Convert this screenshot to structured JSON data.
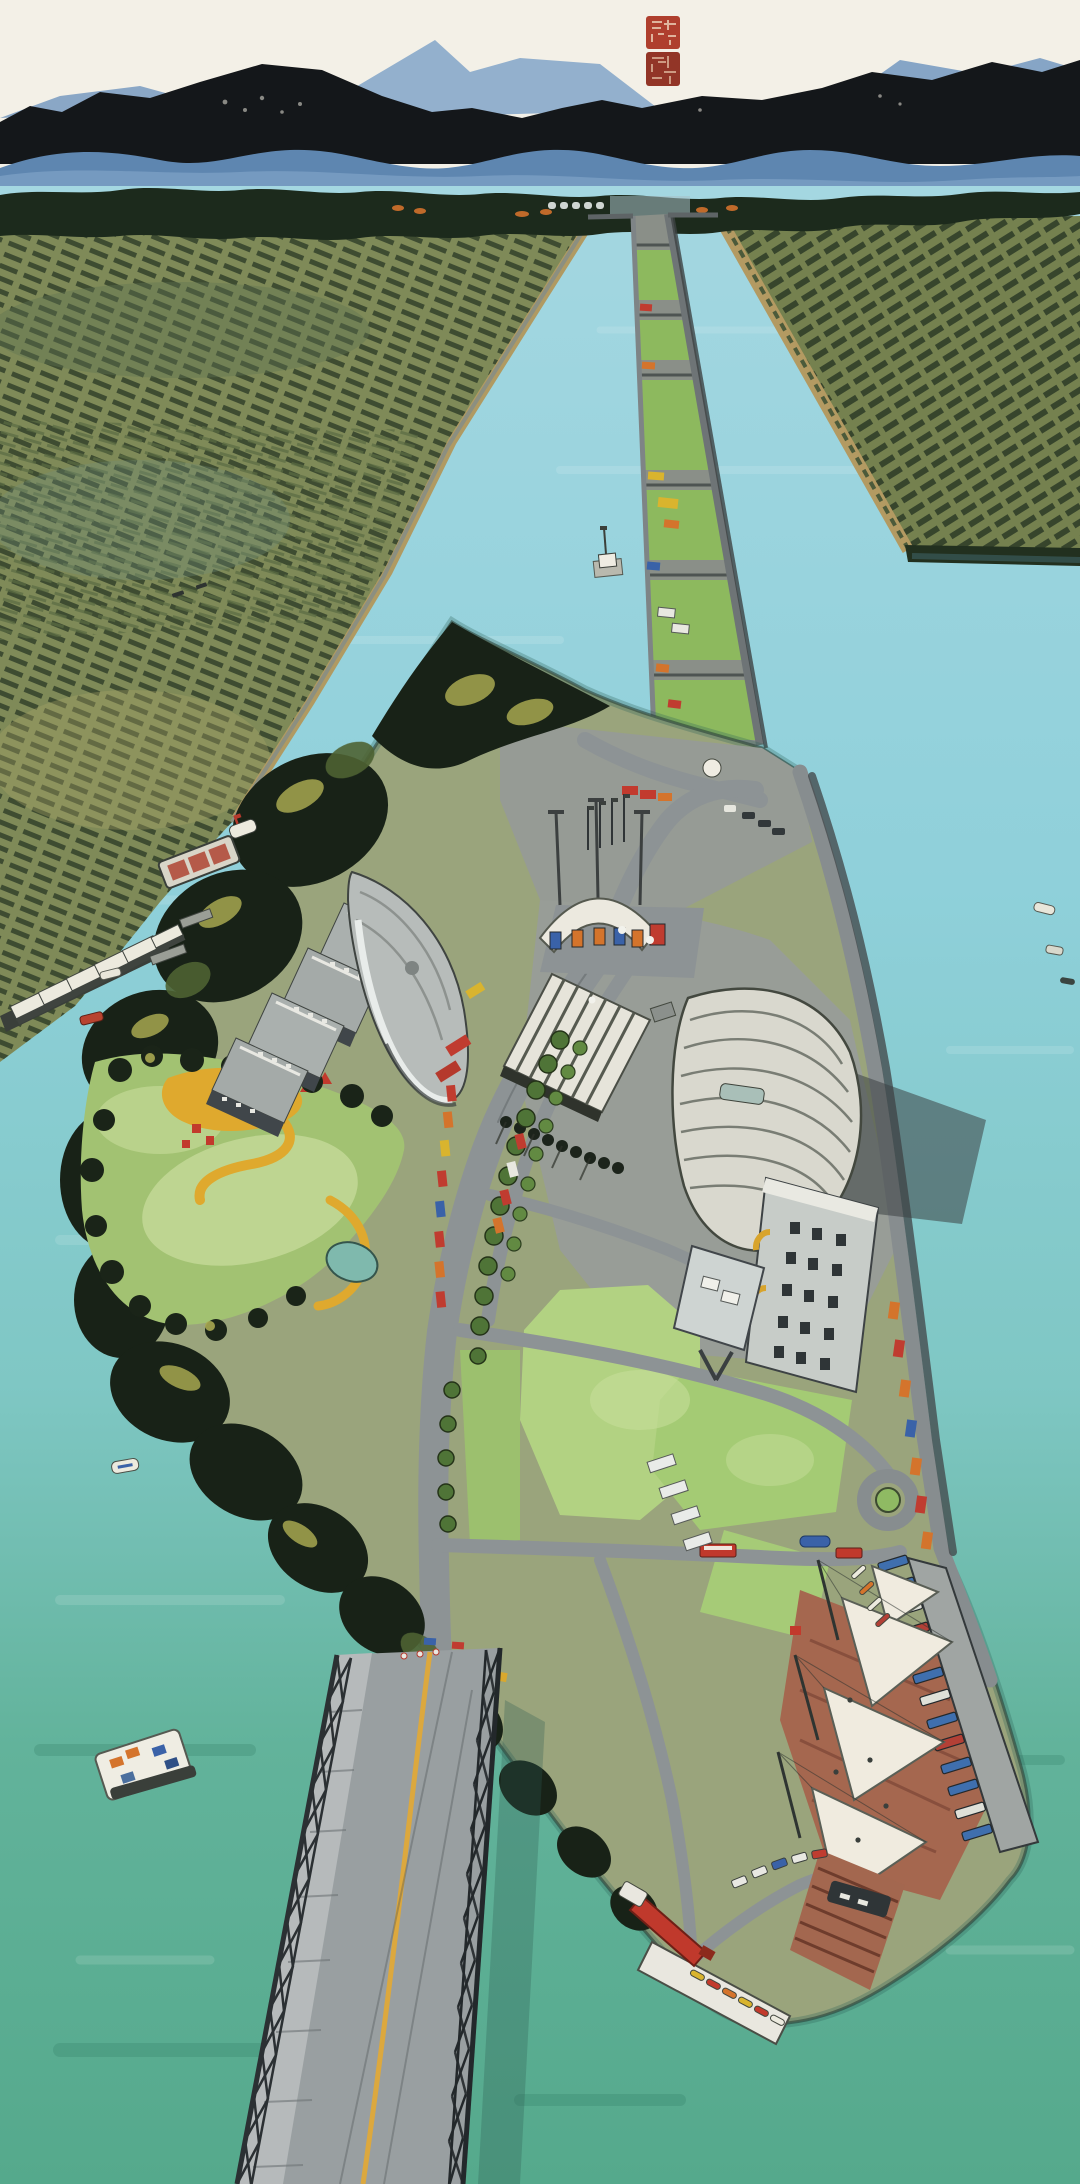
{
  "artwork": {
    "type": "aerial landscape painting",
    "style": "Chinese ink and watercolor on paper",
    "orientation": "portrait",
    "description": "Bird's-eye view of a long river island in a wide turquoise canal: distant blue mountains under a pale paper sky, orchard fields on both banks, a straight canal receding to the horizon with a narrow mid-river lock dike, a developed island with a toll gate, office blocks, arched exhibition halls, a park, tree-lined roads, a sail-canopy marina with moored boats, and a steel truss bridge crossing the green water at the bottom; two red artist seals at the top right."
  },
  "seals": {
    "count": 2,
    "description": "square red artist seals with illegible carved seal-script characters",
    "color": "#a9321f",
    "items": [
      {
        "name": "upper-seal",
        "shape": "square"
      },
      {
        "name": "lower-seal",
        "shape": "square"
      }
    ]
  },
  "palette": {
    "paper": "#f3f0e7",
    "ink_mountains": "#14171a",
    "blue_mountains": "#7fa2c6",
    "tree_line": "#1c2a1c",
    "fields_olive": "#7f8a58",
    "water_upper": "#a4d7e1",
    "water_lower": "#55a98c",
    "island_concrete": "#989d97",
    "lawn_green": "#a9c878",
    "road_gray": "#8d9395",
    "roof_white": "#e6e4da",
    "brick_red": "#a5674f",
    "sail_white": "#f0ebdf",
    "boat_blue": "#3f6fae",
    "truck_red": "#c03c30",
    "truck_orange": "#d4742c",
    "accent_yellow": "#dfa92e",
    "seal_red": "#a9321f"
  },
  "scene": {
    "sky": {
      "description": "pale warm paper-white sky"
    },
    "mountains": {
      "description": "dark ink mountain range over blue foothill ridges with one tall blue peak"
    },
    "horizon": {
      "villages_with_orange_roofs": 6,
      "arched_viaduct": 1
    },
    "fields": {
      "left": "terraced orchards and crop rows in olive and gray greens",
      "right": "diagonal orchard rows edged by a tan canal dike"
    },
    "canal": {
      "description": "long straight canal receding to the horizon, split by a narrow lock dike",
      "water_colors": [
        "#a4d7e1",
        "#55a98c"
      ],
      "mid_dike": {
        "description": "narrow mid-river lock dike with grass plots, work vehicles and a white hut",
        "green_segments": 6,
        "work_vehicles": 9,
        "white_hut": 1
      }
    },
    "island": {
      "description": "long developed island with concrete aprons, lawns, dark tree masses and tree-lined roads",
      "toll_gate": {
        "canopy": "white arch",
        "booths": 5,
        "light_poles": 3
      },
      "buildings": [
        {
          "name": "stepped-office-blocks",
          "blocks": 4
        },
        {
          "name": "curved-glass-hall",
          "shape": "lens"
        },
        {
          "name": "striped-roof-pavilion",
          "roof_stripes": 8,
          "colonnade_trees": 9
        },
        {
          "name": "barrel-vault-hangar",
          "ribs": 8,
          "skylight": 1
        },
        {
          "name": "tall-mill-building",
          "window_rows": 6,
          "yellow_arches": 2
        },
        {
          "name": "flat-roof-annex"
        }
      ],
      "park": {
        "lawns": 2,
        "yellow_paths": 3,
        "pond": 1,
        "red_playground_pieces": 5
      },
      "roads": {
        "main_road_tree_rows": 2,
        "roadside_trucks": 19,
        "roundabout": 1,
        "red_shuttle_buses": 2,
        "blue_tanker": 1,
        "white_trailers": 4
      },
      "flagpoles": 4,
      "mast_poles": 3
    },
    "marina": {
      "description": "white tensile sail canopies over a brick plaza beside a pier of moored blue boats",
      "sail_canopies": 4,
      "masts": 3,
      "brick_plaza": true,
      "pier_boats": 13,
      "canoes": 4,
      "kayaks": 6
    },
    "south_wharf": {
      "red_gantry_crane": 1,
      "white_pier": 1,
      "terraced_brick_slope": true,
      "parked_cars": 5,
      "moored_workboat": 1
    },
    "bridge": {
      "description": "steel truss bridge running off the bottom of the picture",
      "type": "steel truss",
      "deck": "gray with yellow center line",
      "sidewalk": "left side",
      "trusses": 2
    },
    "boats_on_water": {
      "white_ferry_barge": 1,
      "cargo_barge_with_red_holds": 1,
      "small_boats": 7
    },
    "shore": {
      "warehouses_with_white_roofs": 6,
      "piers": 2
    }
  }
}
